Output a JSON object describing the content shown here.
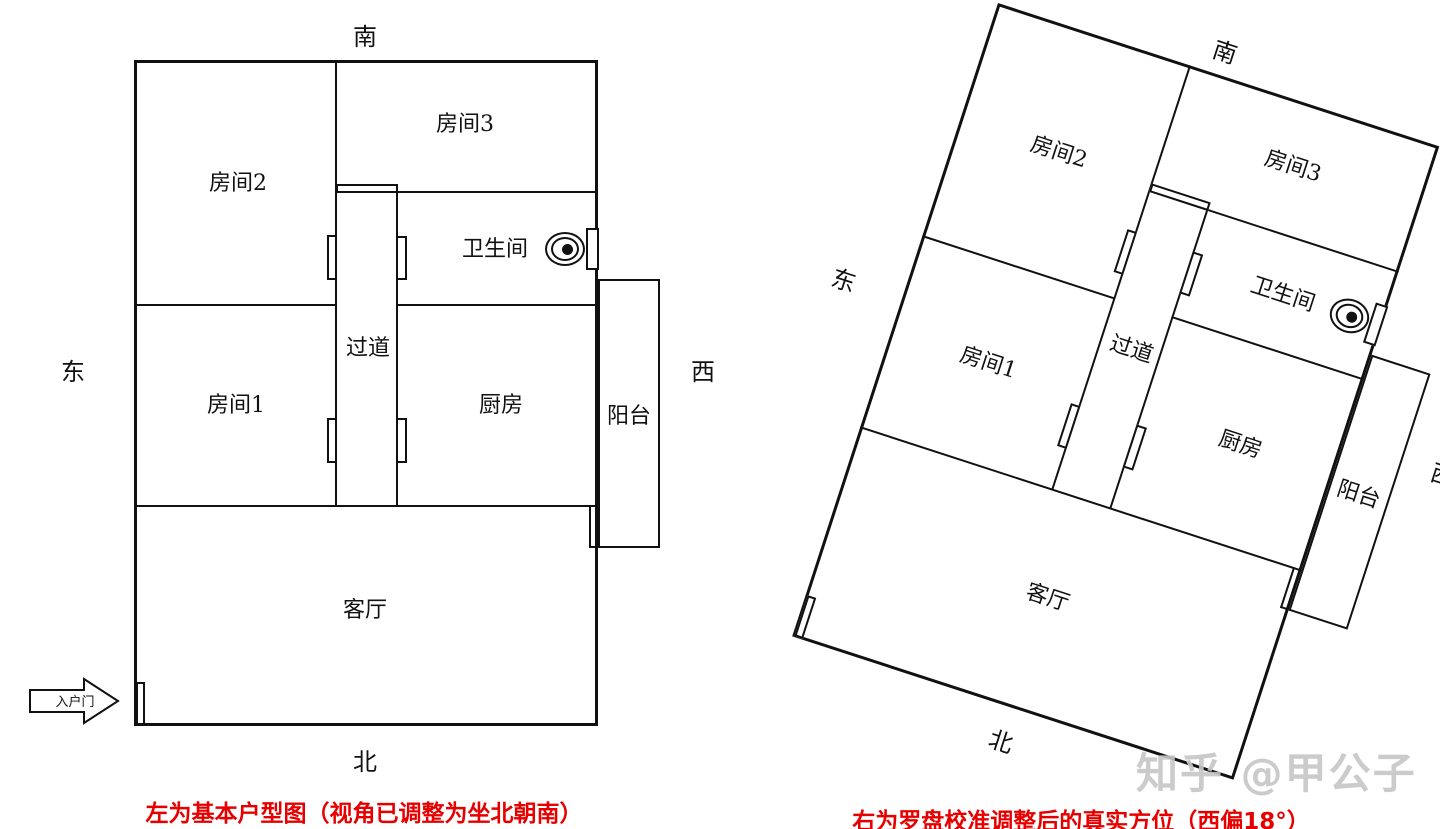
{
  "plan_labels": {
    "room2": "房间2",
    "room3": "房间3",
    "room1": "房间1",
    "corridor": "过道",
    "bathroom": "卫生间",
    "kitchen": "厨房",
    "balcony": "阳台",
    "living_room": "客厅",
    "entry_door": "入户门"
  },
  "compass": {
    "south": "南",
    "north": "北",
    "east": "东",
    "west": "西"
  },
  "captions": {
    "left": "左为基本户型图（视角已调整为坐北朝南）",
    "right": "右为罗盘校准调整后的真实方位（西偏18°）"
  },
  "watermark": {
    "text": "知乎 @甲公子"
  },
  "meta": {
    "right_plan_rotation_deg": 18,
    "wall_color": "#111111",
    "caption_color": "#e60000",
    "watermark_color": "#c6c6c6"
  }
}
